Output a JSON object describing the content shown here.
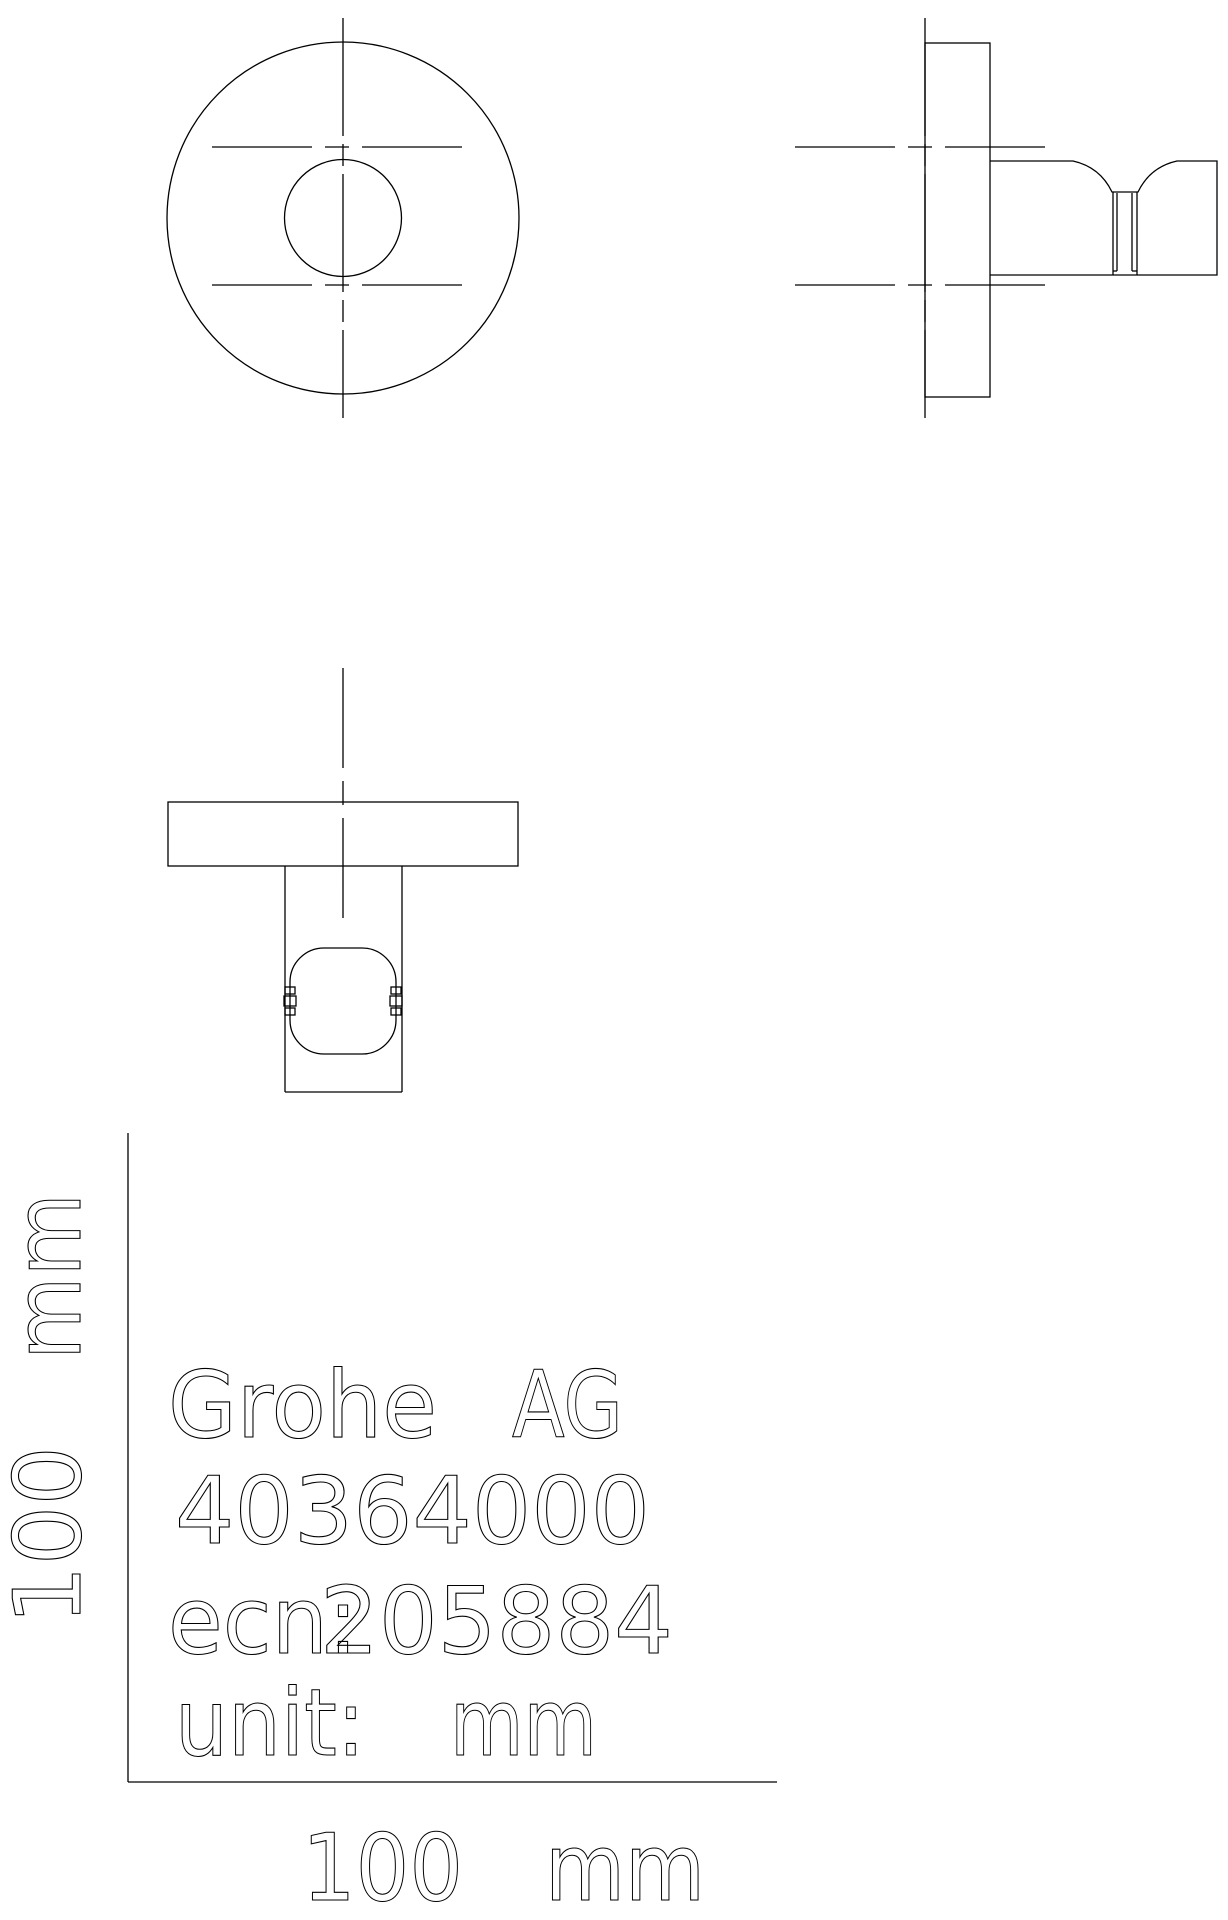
{
  "colors": {
    "background": "#ffffff",
    "ink": "#000000"
  },
  "title_block": {
    "company": "Grohe",
    "company_suffix": "AG",
    "product_number": "40364000",
    "ecn_label": "ecn:",
    "ecn_number": "205884",
    "unit_label": "unit:",
    "unit_value": "mm"
  },
  "scale_bar": {
    "x_value": "100",
    "x_unit": "mm",
    "y_value": "100",
    "y_unit": "mm"
  }
}
